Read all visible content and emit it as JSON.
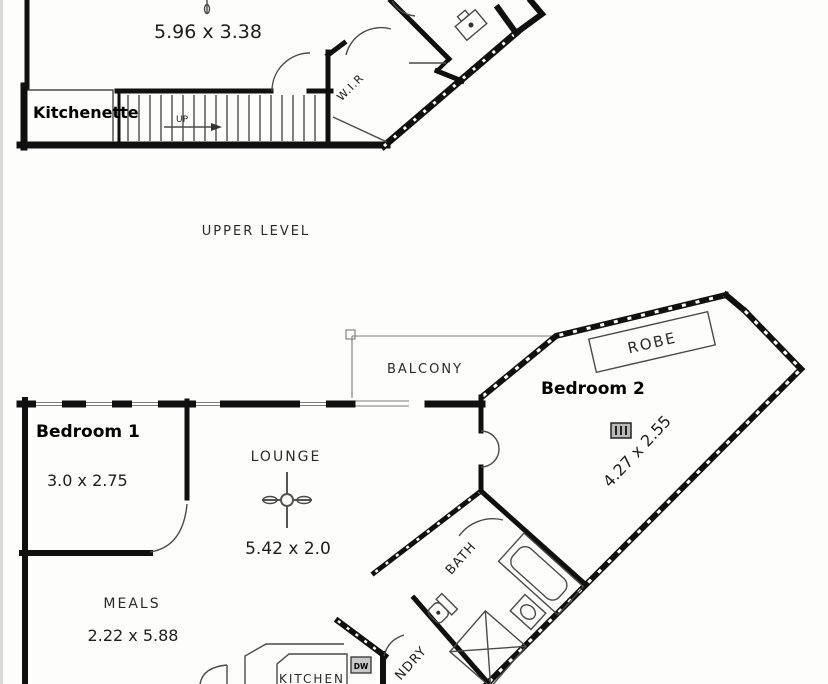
{
  "plan": {
    "upper": {
      "caption": "UPPER LEVEL",
      "room_dims": "5.96 x 3.38",
      "kitchenette": "Kitchenette",
      "stairs_up": "UP",
      "wir": "W.I.R"
    },
    "lower": {
      "balcony": "BALCONY",
      "robe": "ROBE",
      "bedroom2": "Bedroom 2",
      "bedroom2_dims": "4.27 x 2.55",
      "bedroom1": "Bedroom 1",
      "bedroom1_dims": "3.0 x 2.75",
      "lounge": "LOUNGE",
      "lounge_dims": "5.42 x 2.0",
      "meals": "MEALS",
      "meals_dims": "2.22 x 5.88",
      "kitchen": "KITCHEN",
      "dishwasher": "DW",
      "bath": "BATH",
      "laundry": "NDRY"
    },
    "colors": {
      "wall": "#101010",
      "thin_line": "#4a4a4a",
      "text": "#1d1d1d",
      "background": "#fdfdfc"
    }
  }
}
